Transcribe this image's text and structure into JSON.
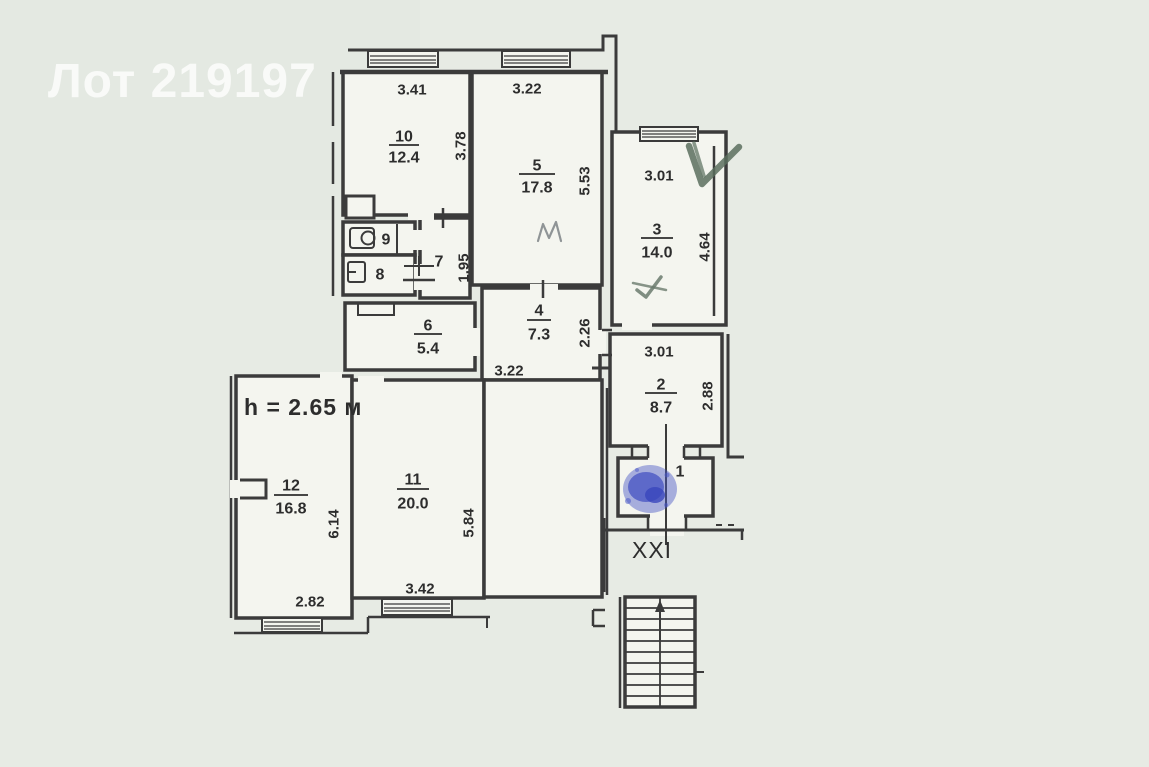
{
  "watermark": "Лот 219197",
  "plan": {
    "height_note": "h = 2.65 м",
    "stair_label": "XXI",
    "rooms": {
      "r1": {
        "num": "1"
      },
      "r2": {
        "num": "2",
        "area": "8.7",
        "dim_w": "3.01",
        "dim_h": "2.88"
      },
      "r3": {
        "num": "3",
        "area": "14.0",
        "dim_w": "3.01",
        "dim_h": "4.64"
      },
      "r4": {
        "num": "4",
        "area": "7.3",
        "dim_w": "3.22",
        "dim_h": "2.26"
      },
      "r5": {
        "num": "5",
        "area": "17.8",
        "dim_w": "3.22",
        "dim_h": "5.53"
      },
      "r6": {
        "num": "6",
        "area": "5.4"
      },
      "r7": {
        "num": "7",
        "dim_h": "1.95"
      },
      "r8": {
        "num": "8"
      },
      "r9": {
        "num": "9"
      },
      "r10": {
        "num": "10",
        "area": "12.4",
        "dim_w": "3.41",
        "dim_h": "3.78"
      },
      "r11": {
        "num": "11",
        "area": "20.0",
        "dim_w": "3.42",
        "dim_h": "5.84"
      },
      "r12": {
        "num": "12",
        "area": "16.8",
        "dim_w": "2.82",
        "dim_h": "6.14"
      }
    }
  },
  "colors": {
    "paper": "#e7ebe4",
    "room_fill": "#f4f5ef",
    "wall": "#3b3b3b",
    "watermark": "#ffffff",
    "pen_green": "#5a6f5e",
    "ink_blue": "#4756c6",
    "pencil_gray": "#8f9496"
  }
}
